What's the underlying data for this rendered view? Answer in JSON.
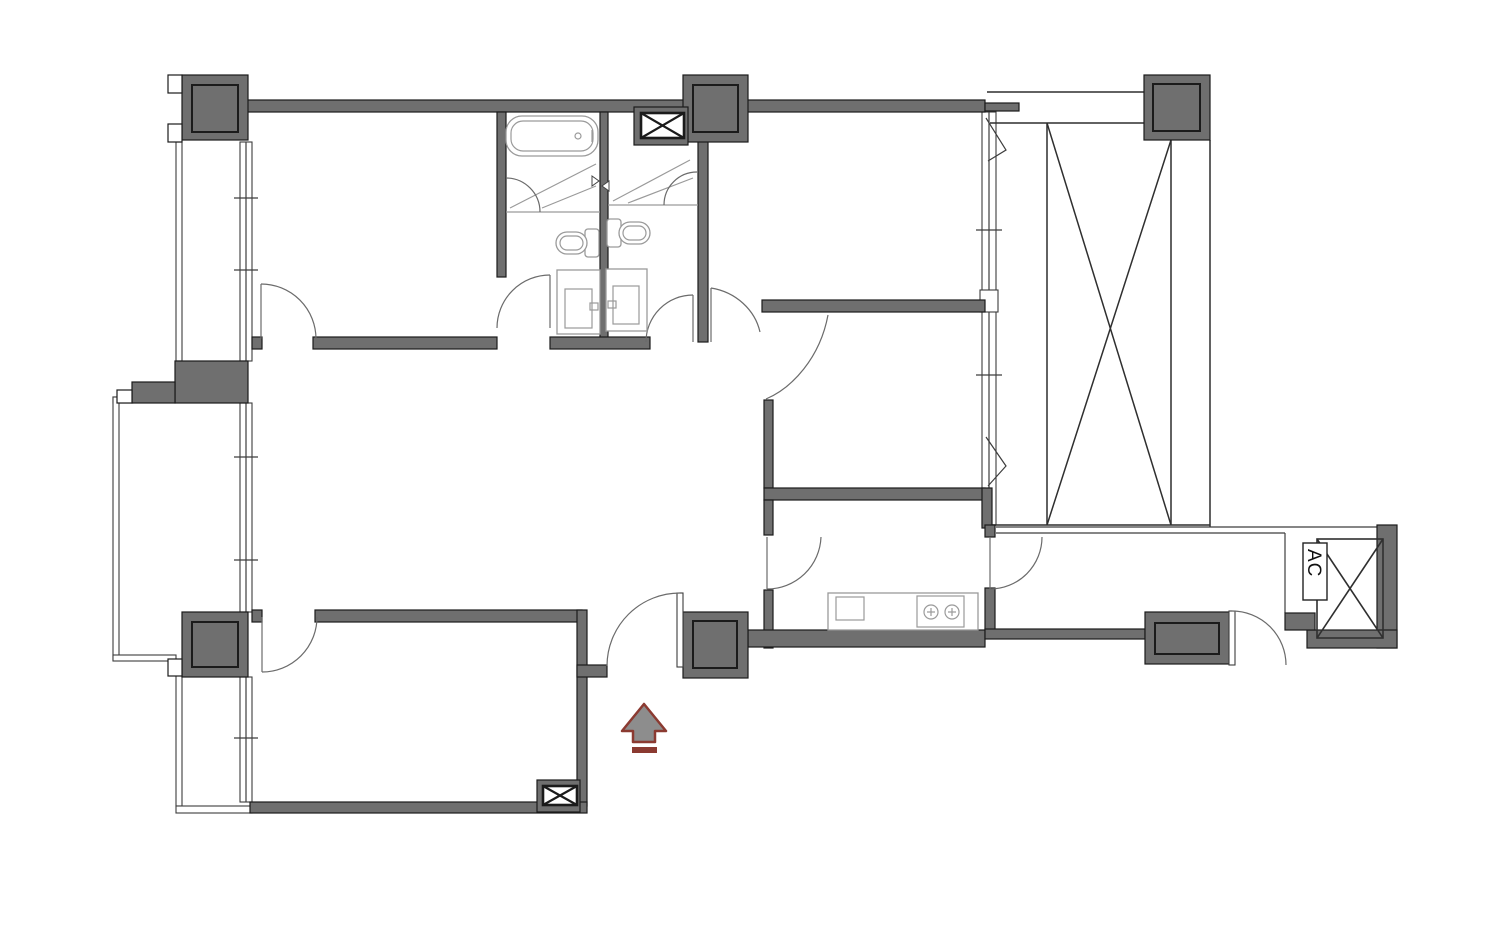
{
  "palette": {
    "wall": "#6f6f6f",
    "outline": "#1b1b1b",
    "thin": "#3d3d3d",
    "fixture": "#9a9a9a",
    "door": "#6b6b6b",
    "arrow_fill": "#8d8d8d",
    "arrow_stroke": "#8b3a31"
  },
  "labels": {
    "ac": "AC"
  },
  "plan": {
    "type": "apartment-floor-plan",
    "features": [
      "structural-columns",
      "window-bands",
      "balcony-strips",
      "bathtub",
      "shower-enclosures",
      "toilets",
      "sink-vanities",
      "kitchen-counter",
      "kitchen-sink",
      "stove-2-burner",
      "void-shaft-x",
      "pipe-shaft-x-boxes",
      "ac-unit-closet",
      "door-swing-arcs",
      "entry-direction-arrow"
    ]
  }
}
